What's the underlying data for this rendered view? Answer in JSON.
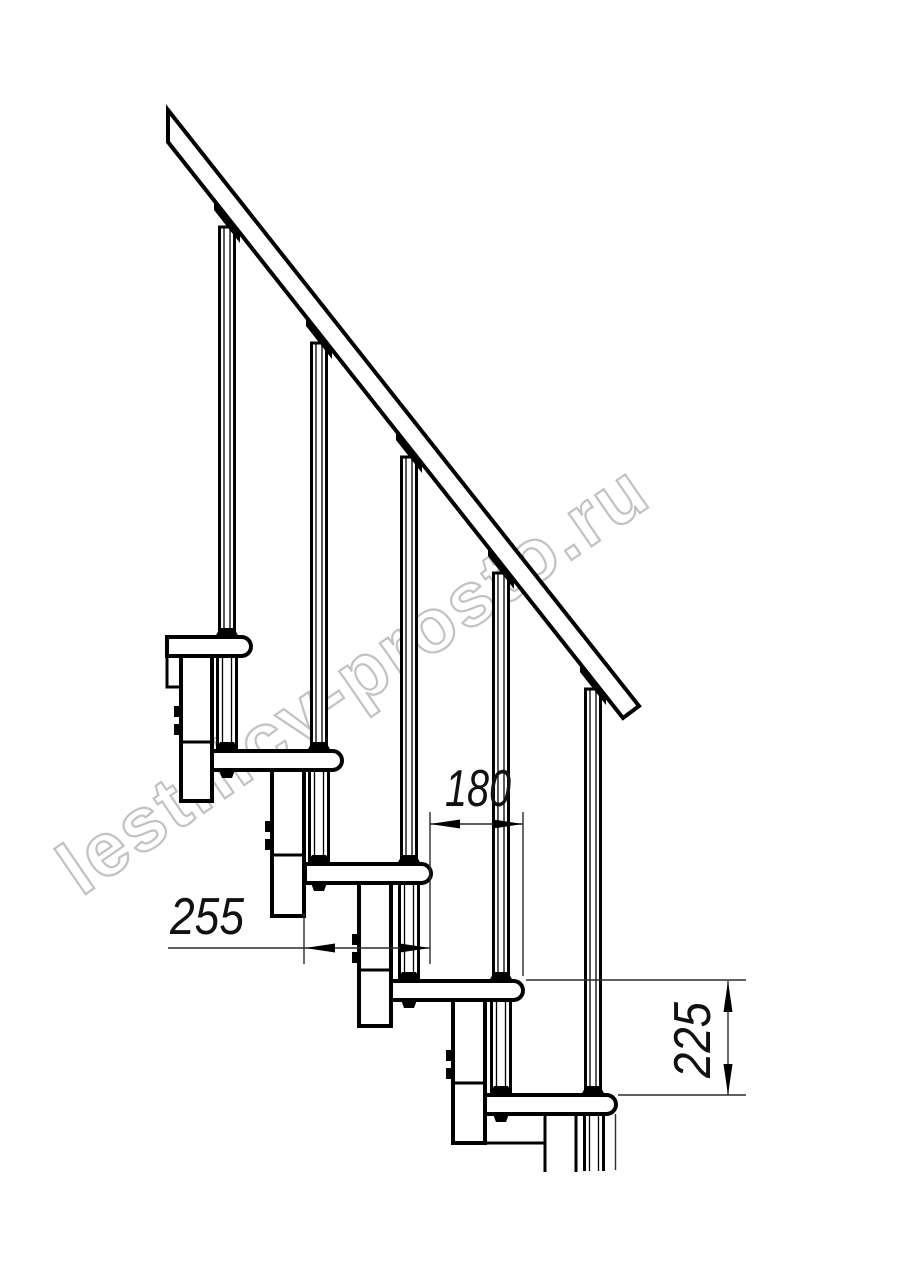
{
  "watermark_text": "lestnicy-prosto.ru",
  "dimensions": {
    "tread_depth": "255",
    "step_run": "180",
    "step_rise": "225"
  },
  "colors": {
    "line": "#000000",
    "thin_line": "#2b2b2b",
    "watermark": "#c2c2c2",
    "background": "#ffffff"
  }
}
